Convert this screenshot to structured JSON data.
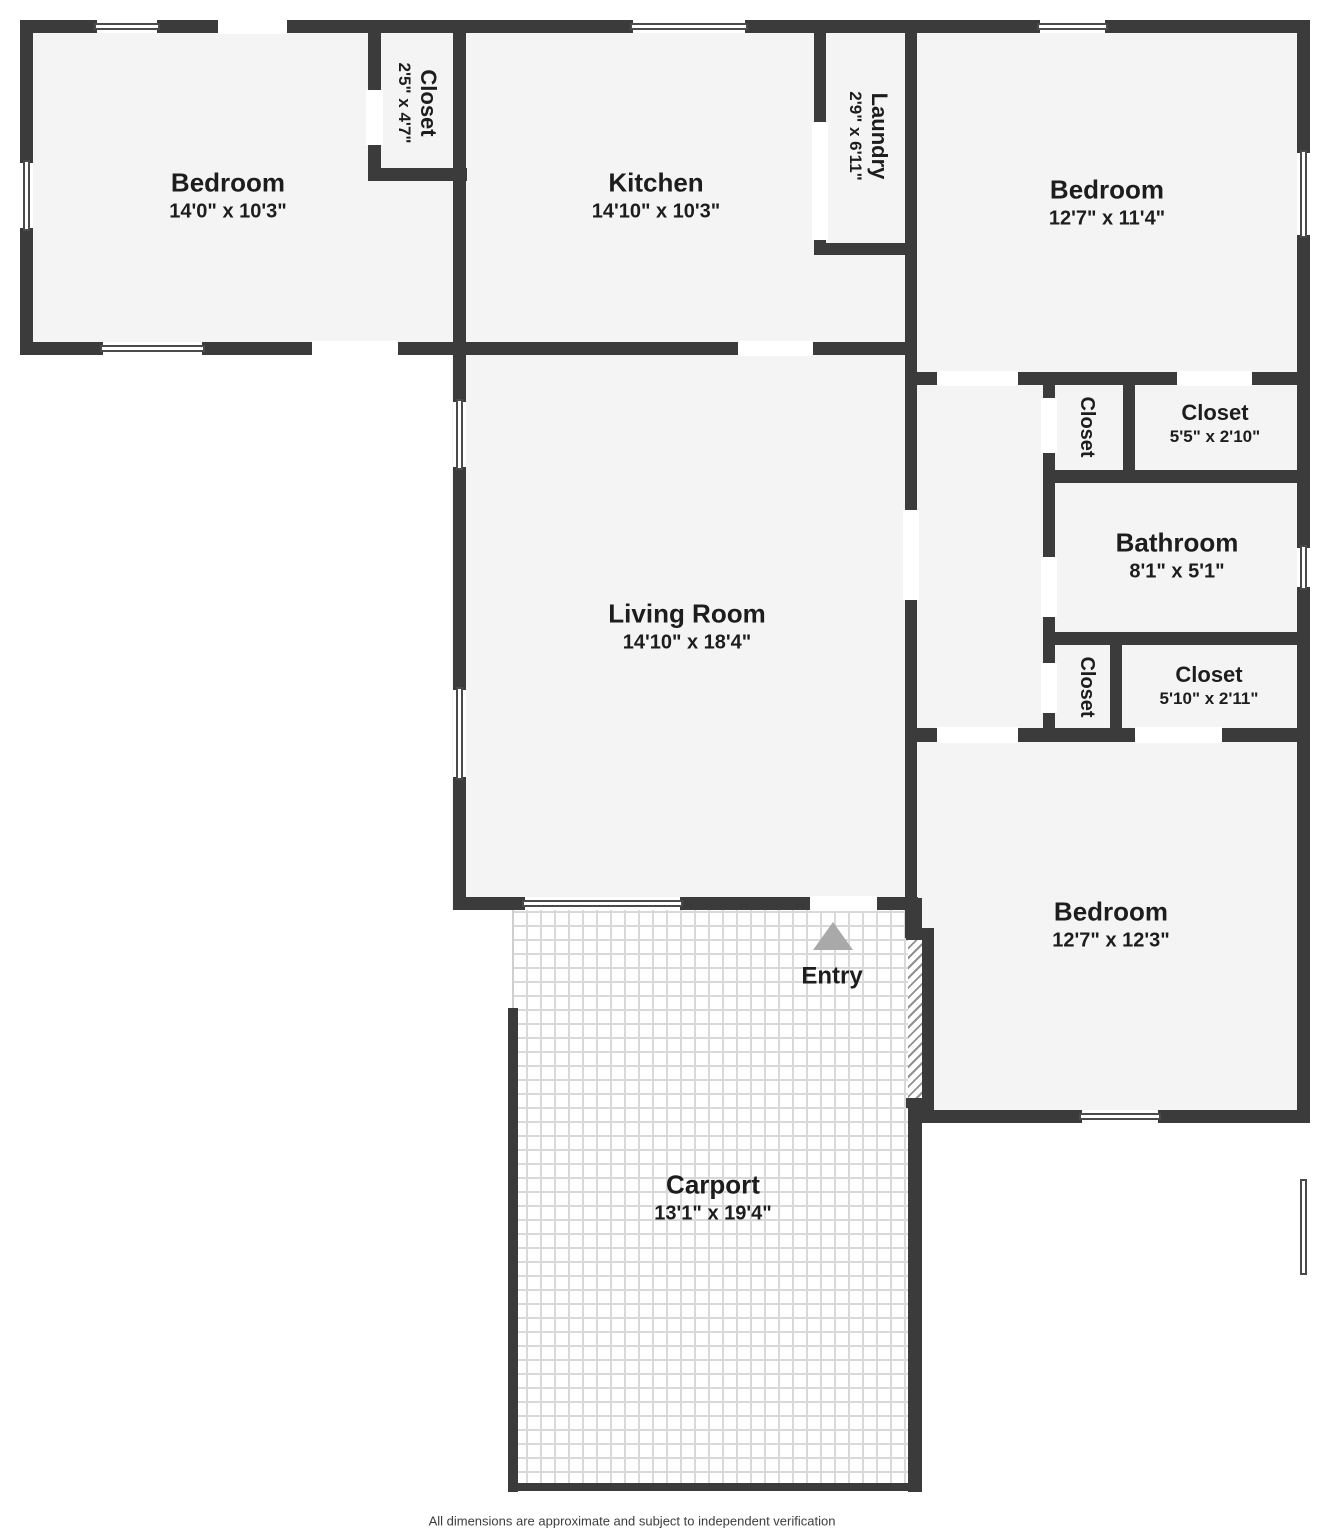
{
  "page": {
    "footer": "All dimensions are approximate and subject to independent verification"
  },
  "palette": {
    "wall": "#3b3b3b",
    "room": "#f4f4f4",
    "ink": "#1d1d1d",
    "arrow": "#a9a9a9",
    "winframe": "#4a4a4a",
    "tileline": "#d9d9d9",
    "hatchline": "#909090",
    "footerink": "#3d3d3d"
  },
  "rooms": [
    {
      "id": "bedroom-tl",
      "name": "Bedroom",
      "dims": "14'0\" x 10'3\""
    },
    {
      "id": "closet-tl",
      "name": "Closet",
      "dims": "2'5\" x 4'7\""
    },
    {
      "id": "kitchen",
      "name": "Kitchen",
      "dims": "14'10\" x 10'3\""
    },
    {
      "id": "laundry",
      "name": "Laundry",
      "dims": "2'9\" x 6'11\""
    },
    {
      "id": "bedroom-tr",
      "name": "Bedroom",
      "dims": "12'7\" x 11'4\""
    },
    {
      "id": "closet-hall-top",
      "name": "Closet"
    },
    {
      "id": "closet-tr",
      "name": "Closet",
      "dims": "5'5\" x 2'10\""
    },
    {
      "id": "bathroom",
      "name": "Bathroom",
      "dims": "8'1\" x 5'1\""
    },
    {
      "id": "closet-hall-bottom",
      "name": "Closet"
    },
    {
      "id": "closet-br",
      "name": "Closet",
      "dims": "5'10\" x 2'11\""
    },
    {
      "id": "living-room",
      "name": "Living Room",
      "dims": "14'10\" x 18'4\""
    },
    {
      "id": "bedroom-br",
      "name": "Bedroom",
      "dims": "12'7\" x 12'3\""
    },
    {
      "id": "entry",
      "name": "Entry"
    },
    {
      "id": "carport",
      "name": "Carport",
      "dims": "13'1\" x 19'4\""
    }
  ]
}
